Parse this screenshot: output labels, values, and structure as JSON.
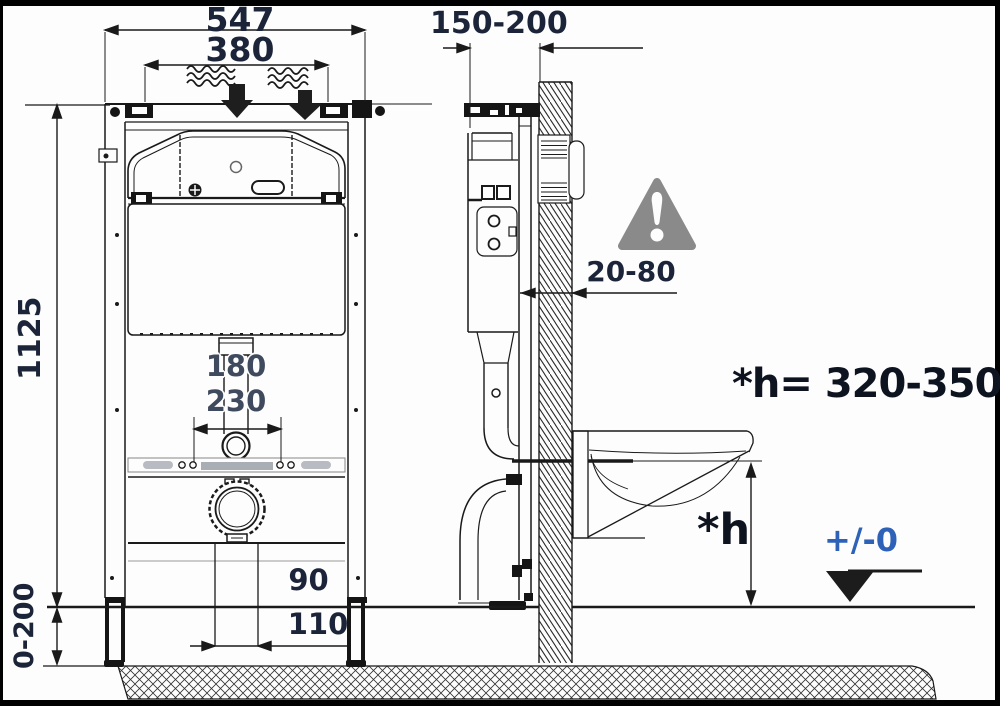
{
  "diagram": {
    "type": "toilet-installation-frame-dimension-drawing",
    "front_view": {
      "overall_width": "547",
      "inner_width": "380",
      "frame_height": "1125",
      "drop_1": "180",
      "drop_2": "230",
      "outlet_dim_1": "90",
      "outlet_dim_2": "110",
      "foot_adjust_range": "0-200"
    },
    "side_view": {
      "depth_range": "150-200",
      "wall_gap_range": "20-80",
      "seat_height_note": "*h= 320-350",
      "seat_height_symbol": "*h",
      "floor_reference": "+/-0"
    },
    "icons": {
      "warning_triangle": "exclamation-warning",
      "floor_level_marker": "filled-triangle-down"
    },
    "colors": {
      "line": "#1a1a1a",
      "dimension_text": "#1b2438",
      "secondary_text": "#3f4a5e",
      "reference_text_blue": "#2e62b8",
      "warning_gray": "#8a8a8a"
    }
  }
}
